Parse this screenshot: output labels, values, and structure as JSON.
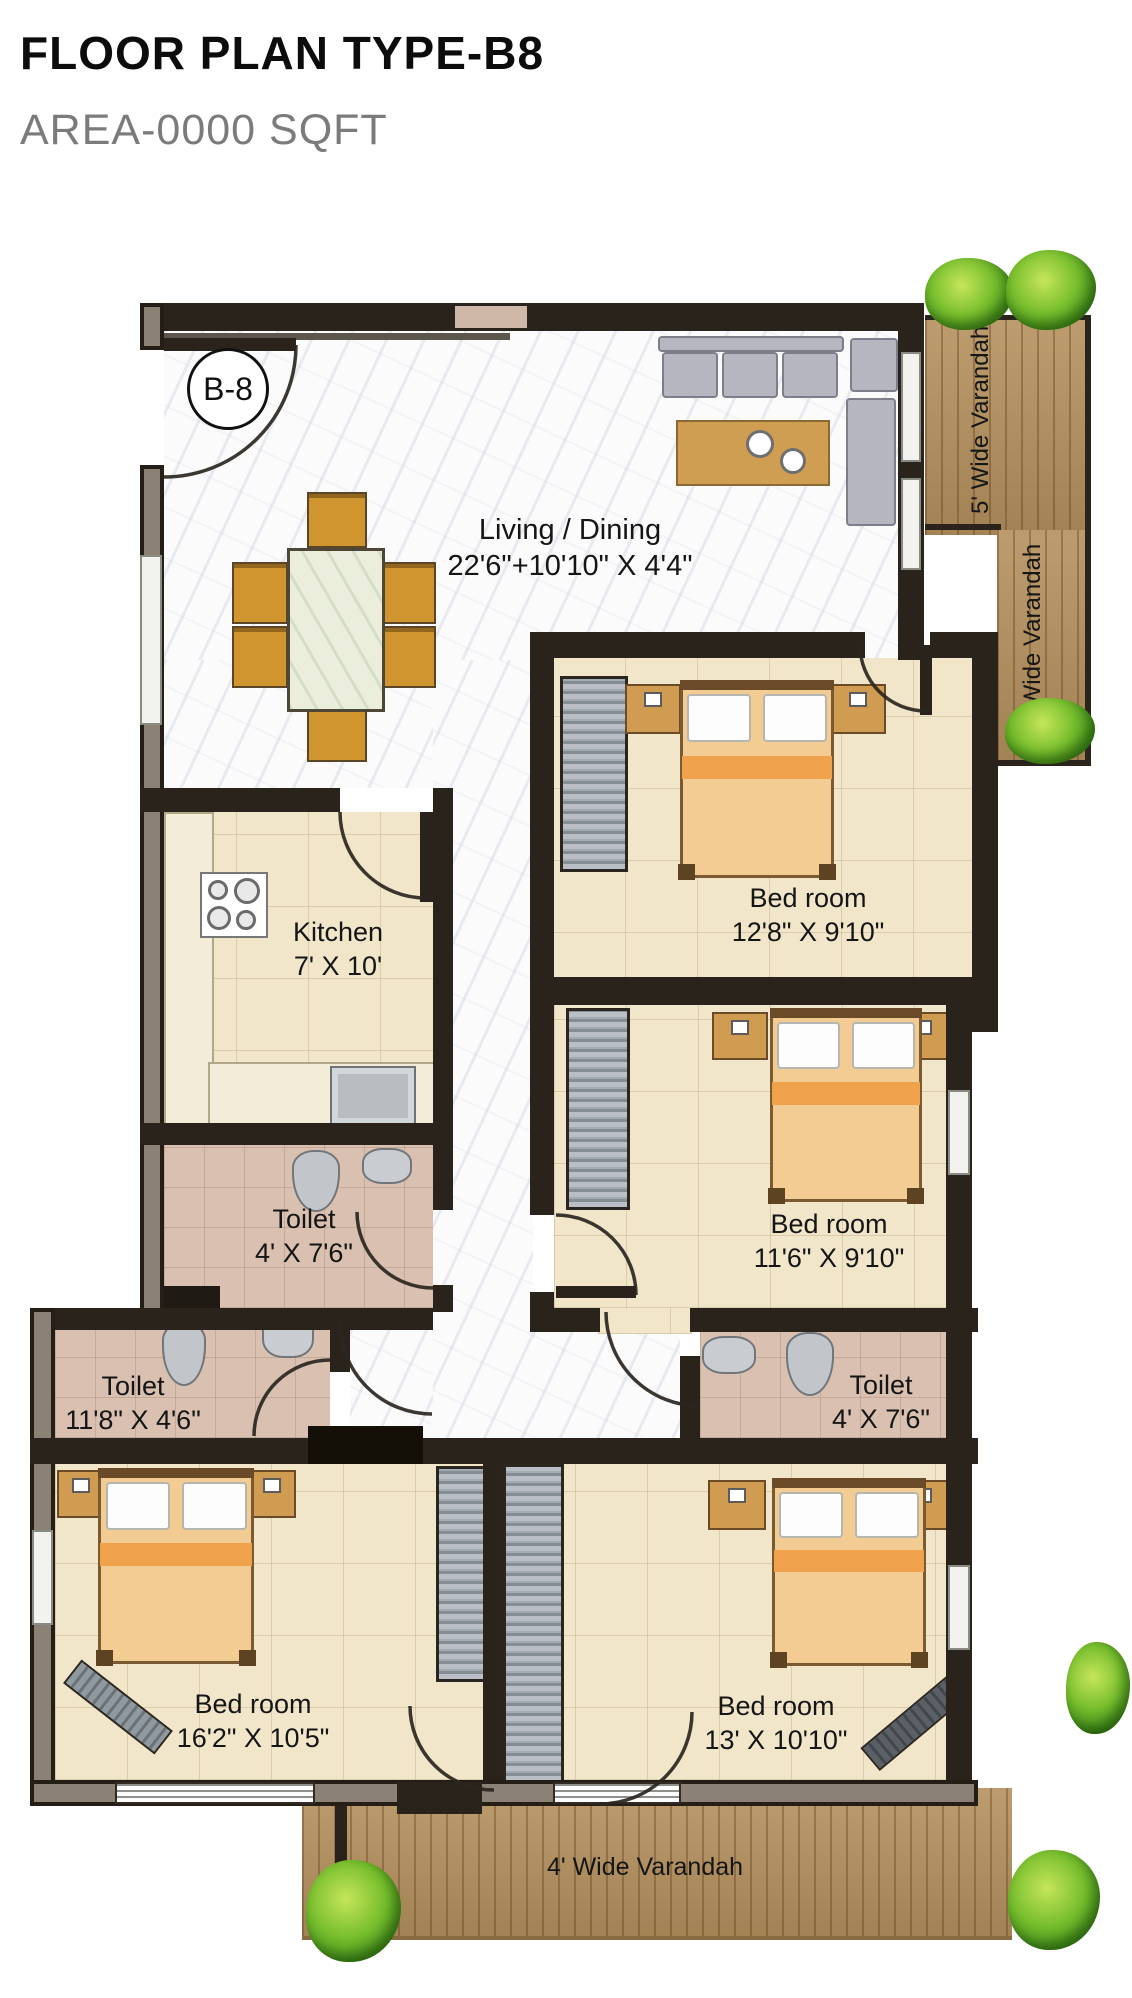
{
  "header": {
    "title": "FLOOR PLAN TYPE-B8",
    "subtitle": "AREA-0000 SQFT"
  },
  "unit": {
    "badge": "B-8"
  },
  "rooms": {
    "living": {
      "name": "Living / Dining",
      "dims": "22'6\"+10'10\" X 4'4\""
    },
    "kitchen": {
      "name": "Kitchen",
      "dims": "7' X 10'"
    },
    "bedroom1": {
      "name": "Bed room",
      "dims": "12'8\" X 9'10\""
    },
    "bedroom2": {
      "name": "Bed room",
      "dims": "11'6\" X 9'10\""
    },
    "bedroom3": {
      "name": "Bed room",
      "dims": "16'2\" X 10'5\""
    },
    "bedroom4": {
      "name": "Bed room",
      "dims": "13' X 10'10\""
    },
    "toilet_kitchen": {
      "name": "Toilet",
      "dims": "4' X 7'6\""
    },
    "toilet_left": {
      "name": "Toilet",
      "dims": "11'8\" X 4'6\""
    },
    "toilet_right": {
      "name": "Toilet",
      "dims": "4' X 7'6\""
    }
  },
  "verandahs": {
    "right_upper": "5' Wide Varandah",
    "right_lower": "3' Wide Varandah",
    "bottom": "4' Wide Varandah"
  },
  "palette": {
    "wall": "#29231b",
    "deck_wood": "#b5915e",
    "floor_marble": "#fbfbfc",
    "floor_beige": "#f1e6ca",
    "floor_toilet": "#d9c0b0",
    "bush_green": "#79bf2e",
    "furniture_wood": "#d09e52"
  }
}
